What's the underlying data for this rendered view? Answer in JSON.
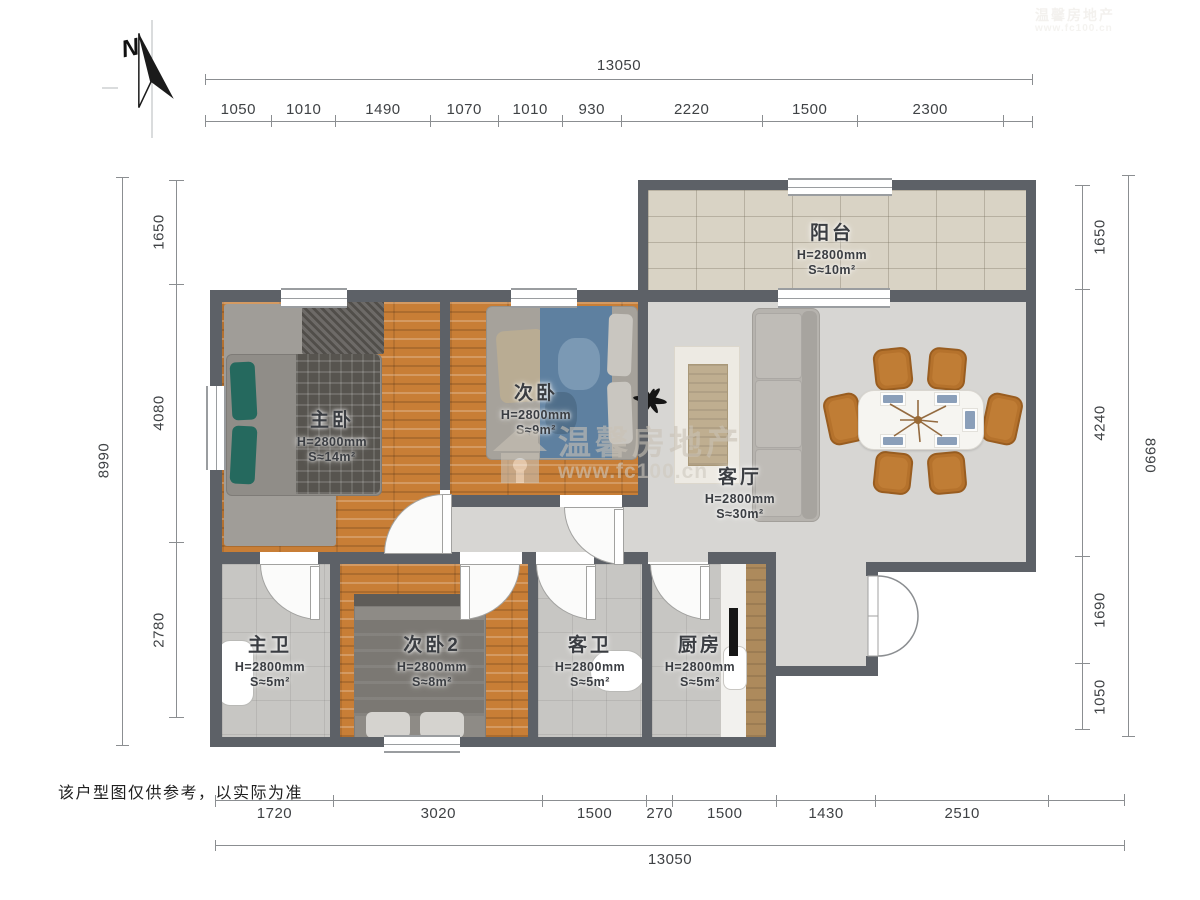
{
  "meta": {
    "disclaimer": "该户型图仅供参考，以实际为准",
    "north_label": "N"
  },
  "watermark": {
    "brand": "温馨房地产",
    "url": "www.fc100.cn"
  },
  "dimensions": {
    "top": {
      "total": "13050",
      "segments": [
        "1050",
        "1010",
        "1490",
        "1070",
        "1010",
        "930",
        "2220",
        "1500",
        "2300"
      ]
    },
    "bottom": {
      "total": "13050",
      "segments": [
        "1720",
        "3020",
        "1500",
        "270",
        "1500",
        "1430",
        "2510"
      ]
    },
    "left": {
      "total": "8990",
      "segments": [
        "1650",
        "4080",
        "2780"
      ]
    },
    "right": {
      "total": "8990",
      "segments": [
        "1650",
        "4240",
        "1690",
        "1050"
      ]
    }
  },
  "rooms": [
    {
      "id": "balcony",
      "name": "阳台",
      "height": "H=2800mm",
      "area": "S≈10m²"
    },
    {
      "id": "living-room",
      "name": "客厅",
      "height": "H=2800mm",
      "area": "S≈30m²"
    },
    {
      "id": "master-bedroom",
      "name": "主卧",
      "height": "H=2800mm",
      "area": "S≈14m²"
    },
    {
      "id": "bedroom-2",
      "name": "次卧",
      "height": "H=2800mm",
      "area": "S≈9m²"
    },
    {
      "id": "master-bath",
      "name": "主卫",
      "height": "H=2800mm",
      "area": "S≈5m²"
    },
    {
      "id": "bedroom-3",
      "name": "次卧2",
      "height": "H=2800mm",
      "area": "S≈8m²"
    },
    {
      "id": "guest-bath",
      "name": "客卫",
      "height": "H=2800mm",
      "area": "S≈5m²"
    },
    {
      "id": "kitchen",
      "name": "厨房",
      "height": "H=2800mm",
      "area": "S≈5m²"
    }
  ],
  "colors": {
    "wall": "#5d6167",
    "wood_floor": "#c87e36",
    "balcony_tile": "#d9d3c5",
    "bath_tile": "#c7c6c3",
    "living_floor": "#d7d6d3",
    "teal_pillow": "#25695e",
    "chair_brown": "#b5722c",
    "blanket_blue": "#5e80a0",
    "dimension_text": "#3f4245"
  }
}
